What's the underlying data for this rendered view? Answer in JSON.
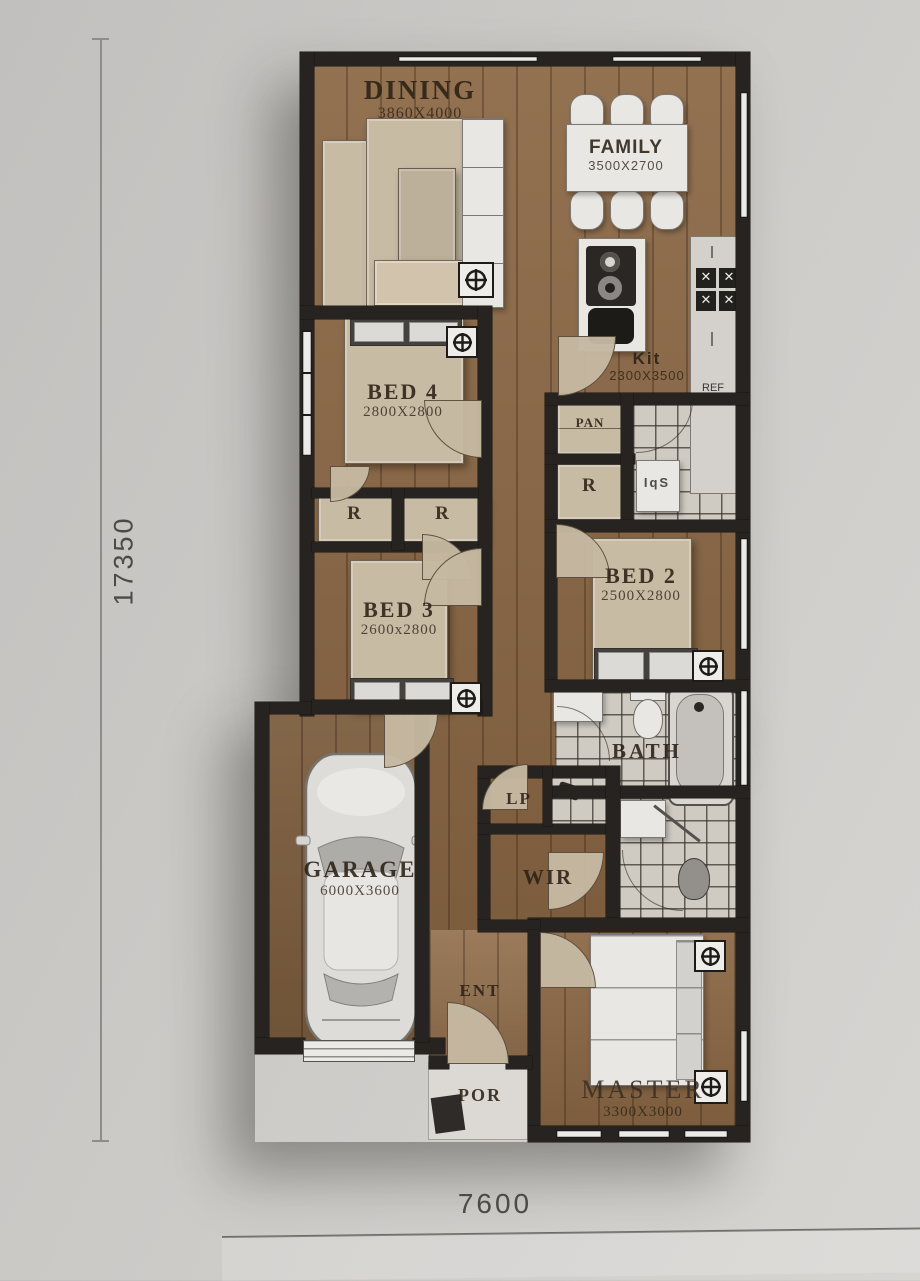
{
  "scene": {
    "type": "architectural floor plan, top-down render of single-storey house"
  },
  "dimensions": {
    "left": "17350",
    "bottom": "7600"
  },
  "rooms": {
    "dining": {
      "label": "DINING",
      "dims": "3860X4000"
    },
    "family": {
      "label": "FAMILY",
      "dims": "3500X2700"
    },
    "kitchen": {
      "label": "Kit",
      "dims": "2300X3500",
      "ref": "REF"
    },
    "pantry": {
      "label": "PAN"
    },
    "laundry": {
      "tub": "IqS"
    },
    "bed4": {
      "label": "BED 4",
      "dims": "2800X2800"
    },
    "bed3": {
      "label": "BED 3",
      "dims": "2600x2800"
    },
    "bed2": {
      "label": "BED 2",
      "dims": "2500X2800"
    },
    "bath": {
      "label": "BATH"
    },
    "linen": {
      "label": "LP"
    },
    "wir": {
      "label": "WIR"
    },
    "garage": {
      "label": "GARAGE",
      "dims": "6000X3600"
    },
    "entry": {
      "label": "ENT"
    },
    "porch": {
      "label": "POR"
    },
    "master": {
      "label": "MASTER",
      "dims": "3300X3000"
    },
    "robes": {
      "a": "R",
      "b": "R",
      "c": "R"
    }
  },
  "icons": {
    "ceiling_fan": "circle-with-cross light/fan symbol",
    "cooktop_burner": "dark square burner with cross"
  },
  "colors": {
    "background": "#cbc9c6",
    "wall": "#262320",
    "wood_floor": "#8a6744",
    "tile": "#cfcac2",
    "furniture_beige": "#c8bba4",
    "fixture_white": "#e9e7e3"
  }
}
